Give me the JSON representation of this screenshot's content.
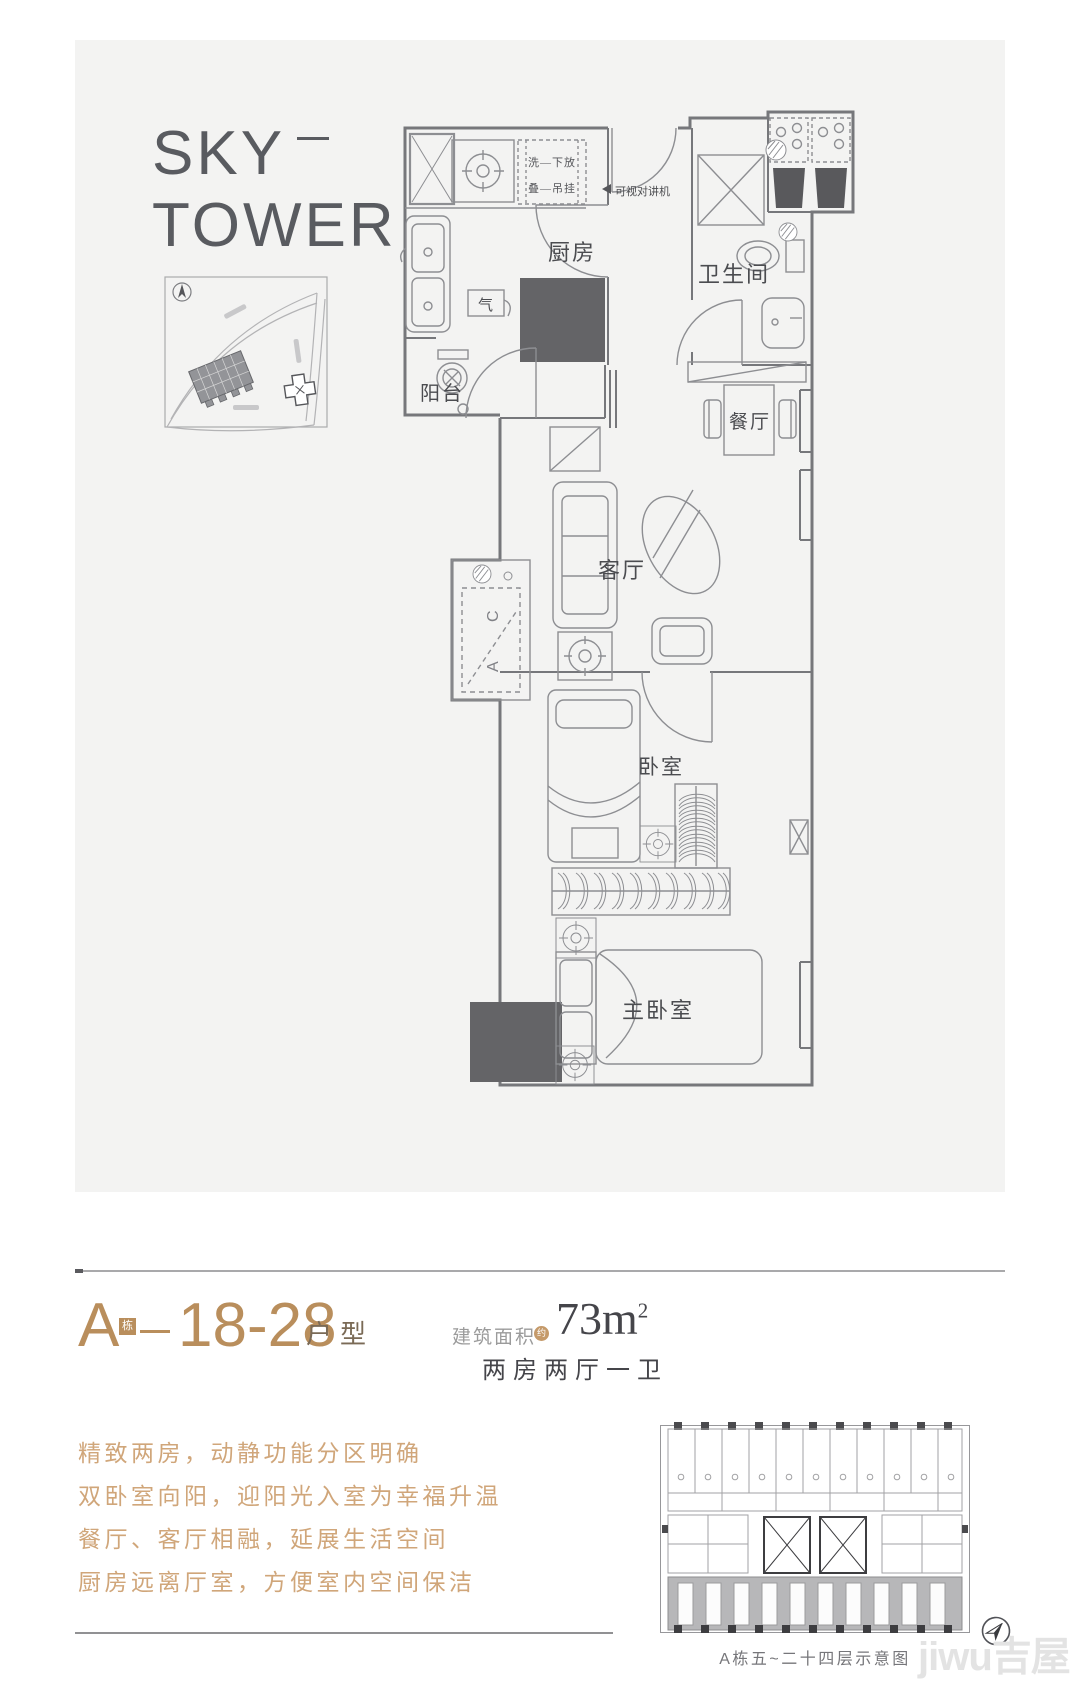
{
  "brand": {
    "line1": "SKY",
    "line2": "TOWER"
  },
  "floor_plan": {
    "rooms": {
      "kitchen": "厨房",
      "balcony": "阳台",
      "bathroom": "卫生间",
      "dining": "餐厅",
      "living": "客厅",
      "bedroom": "卧室",
      "master_bedroom": "主卧室"
    },
    "notes": {
      "washer_top": "洗—下放",
      "washer_bottom": "叠—吊挂",
      "intercom": "可视对讲机",
      "gas": "气",
      "ac_c": "C",
      "ac_a": "A"
    }
  },
  "unit": {
    "block": "A",
    "block_badge": "栋",
    "number_range": "18-28",
    "suffix": "户型",
    "area_label": "建筑面积",
    "area_approx_badge": "约",
    "area_number": "73",
    "area_unit": "m",
    "area_exponent": "2",
    "layout_summary": "两房两厅一卫"
  },
  "description_lines": [
    "精致两房，动静功能分区明确",
    "双卧室向阳，迎阳光入室为幸福升温",
    "餐厅、客厅相融，延展生活空间",
    "厨房远离厅室，方便室内空间保洁"
  ],
  "schematic_caption": "A栋五~二十四层示意图",
  "watermark": "jiwu吉屋",
  "colors": {
    "accent_tan": "#b98e5c",
    "desc_tan": "#d0a67a",
    "suffix_brown": "#7a6a56",
    "logo_gray": "#595b60",
    "panel_gray": "#f3f3f2",
    "plan_line": "#76777b",
    "dark_fill": "#646467",
    "schematic_highlight": "#b7b7b9",
    "watermark_gray": "#e3e3e3"
  }
}
